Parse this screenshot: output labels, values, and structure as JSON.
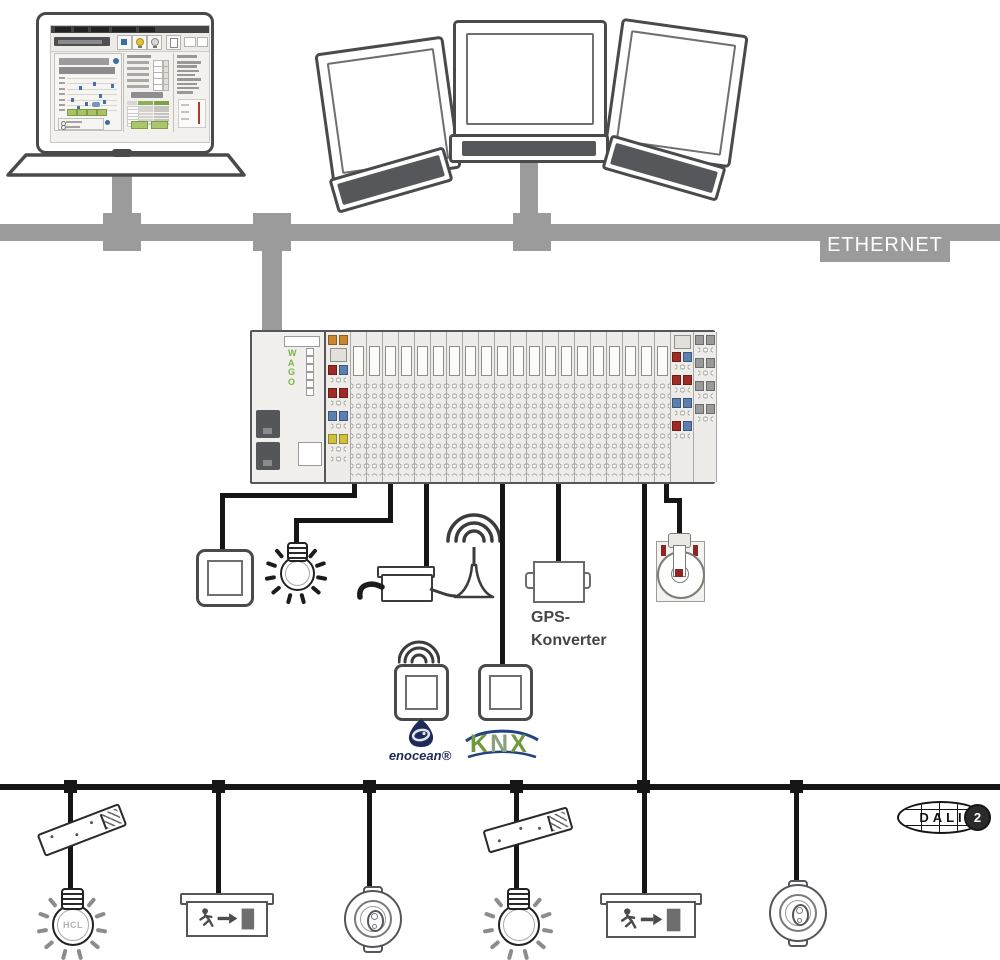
{
  "labels": {
    "ethernet": "ETHERNET",
    "gps_line1": "GPS-",
    "gps_line2": "Konverter",
    "enocean": "enocean®",
    "knx_k": "K",
    "knx_n": "N",
    "knx_x": "X",
    "dali": "DALI",
    "dali_badge": "2",
    "hcl": "HCL",
    "wago": "WAGO"
  },
  "colors": {
    "bus_gray": "#9b9b9b",
    "wire_black": "#161616",
    "outline_dark": "#4a4a4c",
    "wago_green": "#7ab648",
    "enocean_navy": "#1f2a56",
    "knx_green": "#6e9a3c",
    "knx_gray_green": "#8aa07e",
    "knx_blue": "#23427e",
    "led_orange": "#c8862e",
    "led_red": "#9e2b25",
    "led_blue": "#5b7fae",
    "led_yellow": "#cfc23a",
    "led_gray": "#9a9a9a",
    "sensor_red": "#8e2424",
    "ray_black": "#1c1c1c",
    "ray_gray": "#8c8c8c",
    "ui_green": "#a3c162",
    "ui_blue": "#3a6ea5"
  },
  "rack": {
    "plain_module_count": 20,
    "led_left_rows": [
      [
        "orange",
        "orange"
      ],
      "panel",
      [
        "red",
        "blue"
      ],
      "dots1",
      [
        "red",
        "red"
      ],
      "dots1",
      [
        "blue",
        "blue"
      ],
      "dots1",
      [
        "yellow",
        "yellow"
      ],
      "dots2"
    ],
    "led_right_a_rows": [
      "panel",
      [
        "red",
        "blue"
      ],
      "dots1",
      [
        "red",
        "red"
      ],
      "dots1",
      [
        "blue",
        "blue"
      ],
      "dots1",
      [
        "red",
        "blue"
      ],
      "dots1"
    ],
    "led_right_b_rows": [
      [
        "gray",
        "gray"
      ],
      "dots1",
      [
        "gray",
        "gray"
      ],
      "dots1",
      [
        "gray",
        "gray"
      ],
      "dots1",
      [
        "gray",
        "gray"
      ],
      "dots1"
    ]
  },
  "laptop_ui": {
    "menu_segment_widths": [
      16,
      14,
      18,
      24,
      16
    ],
    "form_row_count": 5,
    "table_row_count": 6,
    "right_list_widths": [
      24,
      20,
      22,
      18,
      24,
      20,
      22,
      16
    ]
  }
}
